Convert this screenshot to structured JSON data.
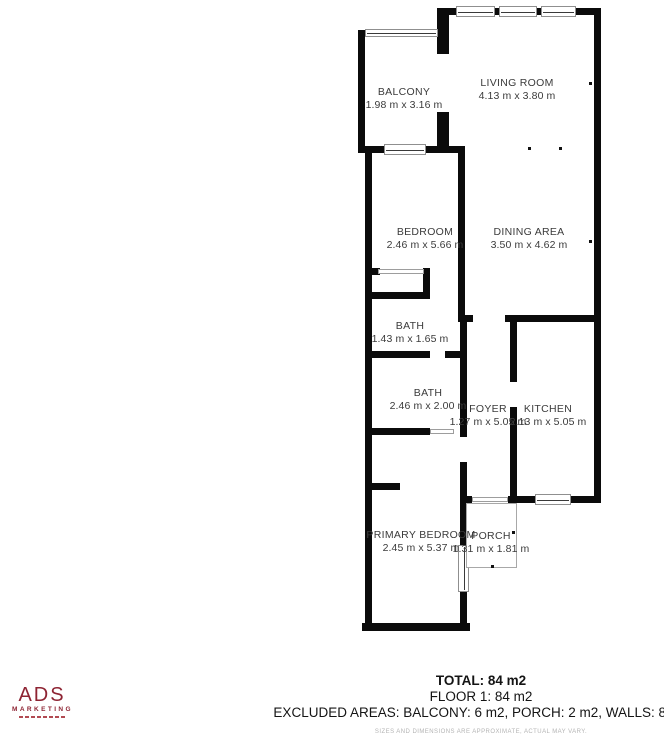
{
  "colors": {
    "wall": "#0b0b0b",
    "room_label_text": "#3b3b3b",
    "logo_red": "#8e2433",
    "footer_text": "#141414",
    "disclaimer_text": "#b4b4b4"
  },
  "rooms": [
    {
      "name": "BALCONY",
      "dims": "1.98 m x 3.16 m"
    },
    {
      "name": "LIVING ROOM",
      "dims": "4.13 m x 3.80 m"
    },
    {
      "name": "BEDROOM",
      "dims": "2.46 m x 5.66 m"
    },
    {
      "name": "DINING AREA",
      "dims": "3.50 m x 4.62 m"
    },
    {
      "name": "BATH",
      "dims": "1.43 m x 1.65 m"
    },
    {
      "name": "BATH",
      "dims": "2.46 m x 2.00 m"
    },
    {
      "name": "FOYER",
      "dims": "1.27 m x 5.05 m"
    },
    {
      "name": "KITCHEN",
      "dims": "2.13 m x 5.05 m"
    },
    {
      "name": "PRIMARY BEDROOM",
      "dims": "2.45 m x 5.37 m"
    },
    {
      "name": "PORCH",
      "dims": "1.31 m x 1.81 m"
    }
  ],
  "footer": {
    "total": "TOTAL: 84 m2",
    "floor": "FLOOR 1: 84 m2",
    "excluded": "EXCLUDED AREAS: BALCONY: 6 m2, PORCH: 2 m2, WALLS: 8 m2",
    "disclaimer": "SIZES AND DIMENSIONS ARE APPROXIMATE, ACTUAL MAY VARY."
  },
  "logo": {
    "brand": "ADS",
    "word": "MARKETING"
  }
}
